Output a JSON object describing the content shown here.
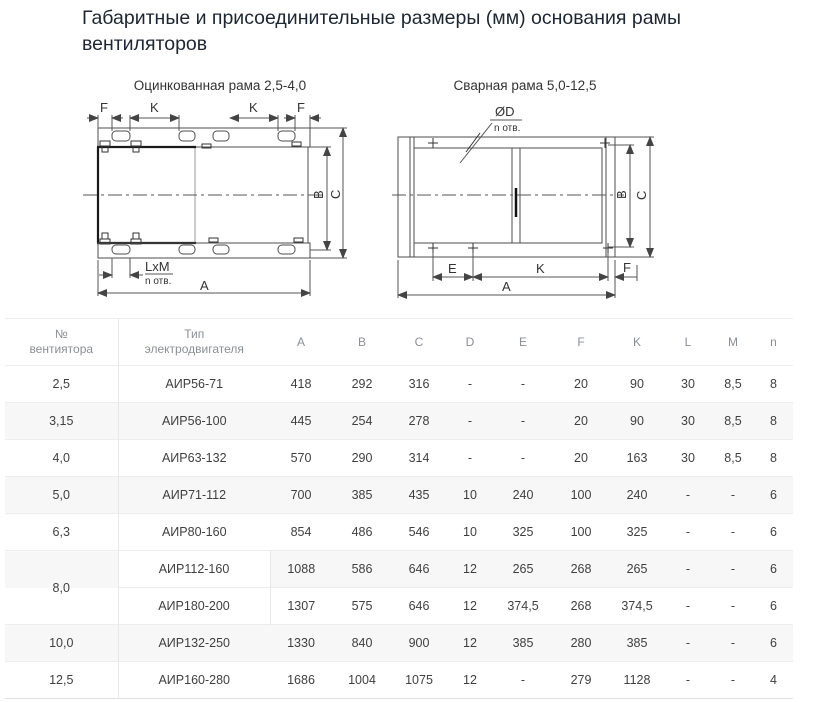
{
  "page": {
    "title": "Габаритные и присоединительные размеры (мм) основания рамы вентиляторов"
  },
  "drawings": {
    "left": {
      "caption": "Оцинкованная рама 2,5-4,0",
      "labels": {
        "f1": "F",
        "k1": "K",
        "k2": "K",
        "f2": "F",
        "lxm": "LxM",
        "n_otv": "n отв.",
        "a": "A",
        "b": "B",
        "c": "C"
      }
    },
    "right": {
      "caption": "Сварная рама 5,0-12,5",
      "labels": {
        "diam": "ØD",
        "n_otv": "n отв.",
        "e": "E",
        "k": "K",
        "f": "F",
        "a": "A",
        "b": "B",
        "c": "C"
      }
    }
  },
  "table": {
    "headers": {
      "fan_no": "№\nвентиятора",
      "motor_type": "Тип\nэлектродвигателя",
      "a": "A",
      "b": "B",
      "c": "C",
      "d": "D",
      "e": "E",
      "f": "F",
      "k": "K",
      "l": "L",
      "m": "M",
      "n": "n"
    },
    "rows": [
      {
        "no": "2,5",
        "type": "АИР56-71",
        "values": [
          "418",
          "292",
          "316",
          "-",
          "-",
          "20",
          "90",
          "30",
          "8,5",
          "8"
        ]
      },
      {
        "no": "3,15",
        "type": "АИР56-100",
        "values": [
          "445",
          "254",
          "278",
          "-",
          "-",
          "20",
          "90",
          "30",
          "8,5",
          "8"
        ]
      },
      {
        "no": "4,0",
        "type": "АИР63-132",
        "values": [
          "570",
          "290",
          "314",
          "-",
          "-",
          "20",
          "163",
          "30",
          "8,5",
          "8"
        ]
      },
      {
        "no": "5,0",
        "type": "АИР71-112",
        "values": [
          "700",
          "385",
          "435",
          "10",
          "240",
          "100",
          "240",
          "-",
          "-",
          "6"
        ]
      },
      {
        "no": "6,3",
        "type": "АИР80-160",
        "values": [
          "854",
          "486",
          "546",
          "10",
          "325",
          "100",
          "325",
          "-",
          "-",
          "6"
        ]
      },
      {
        "no": "8,0",
        "type": "АИР112-160",
        "values": [
          "1088",
          "586",
          "646",
          "12",
          "265",
          "268",
          "265",
          "-",
          "-",
          "6"
        ]
      },
      {
        "no": "",
        "type": "АИР180-200",
        "values": [
          "1307",
          "575",
          "646",
          "12",
          "374,5",
          "268",
          "374,5",
          "-",
          "-",
          "6"
        ]
      },
      {
        "no": "10,0",
        "type": "АИР132-250",
        "values": [
          "1330",
          "840",
          "900",
          "12",
          "385",
          "280",
          "385",
          "-",
          "-",
          "6"
        ]
      },
      {
        "no": "12,5",
        "type": "АИР160-280",
        "values": [
          "1686",
          "1004",
          "1075",
          "12",
          "-",
          "279",
          "1128",
          "-",
          "-",
          "4"
        ]
      }
    ]
  }
}
